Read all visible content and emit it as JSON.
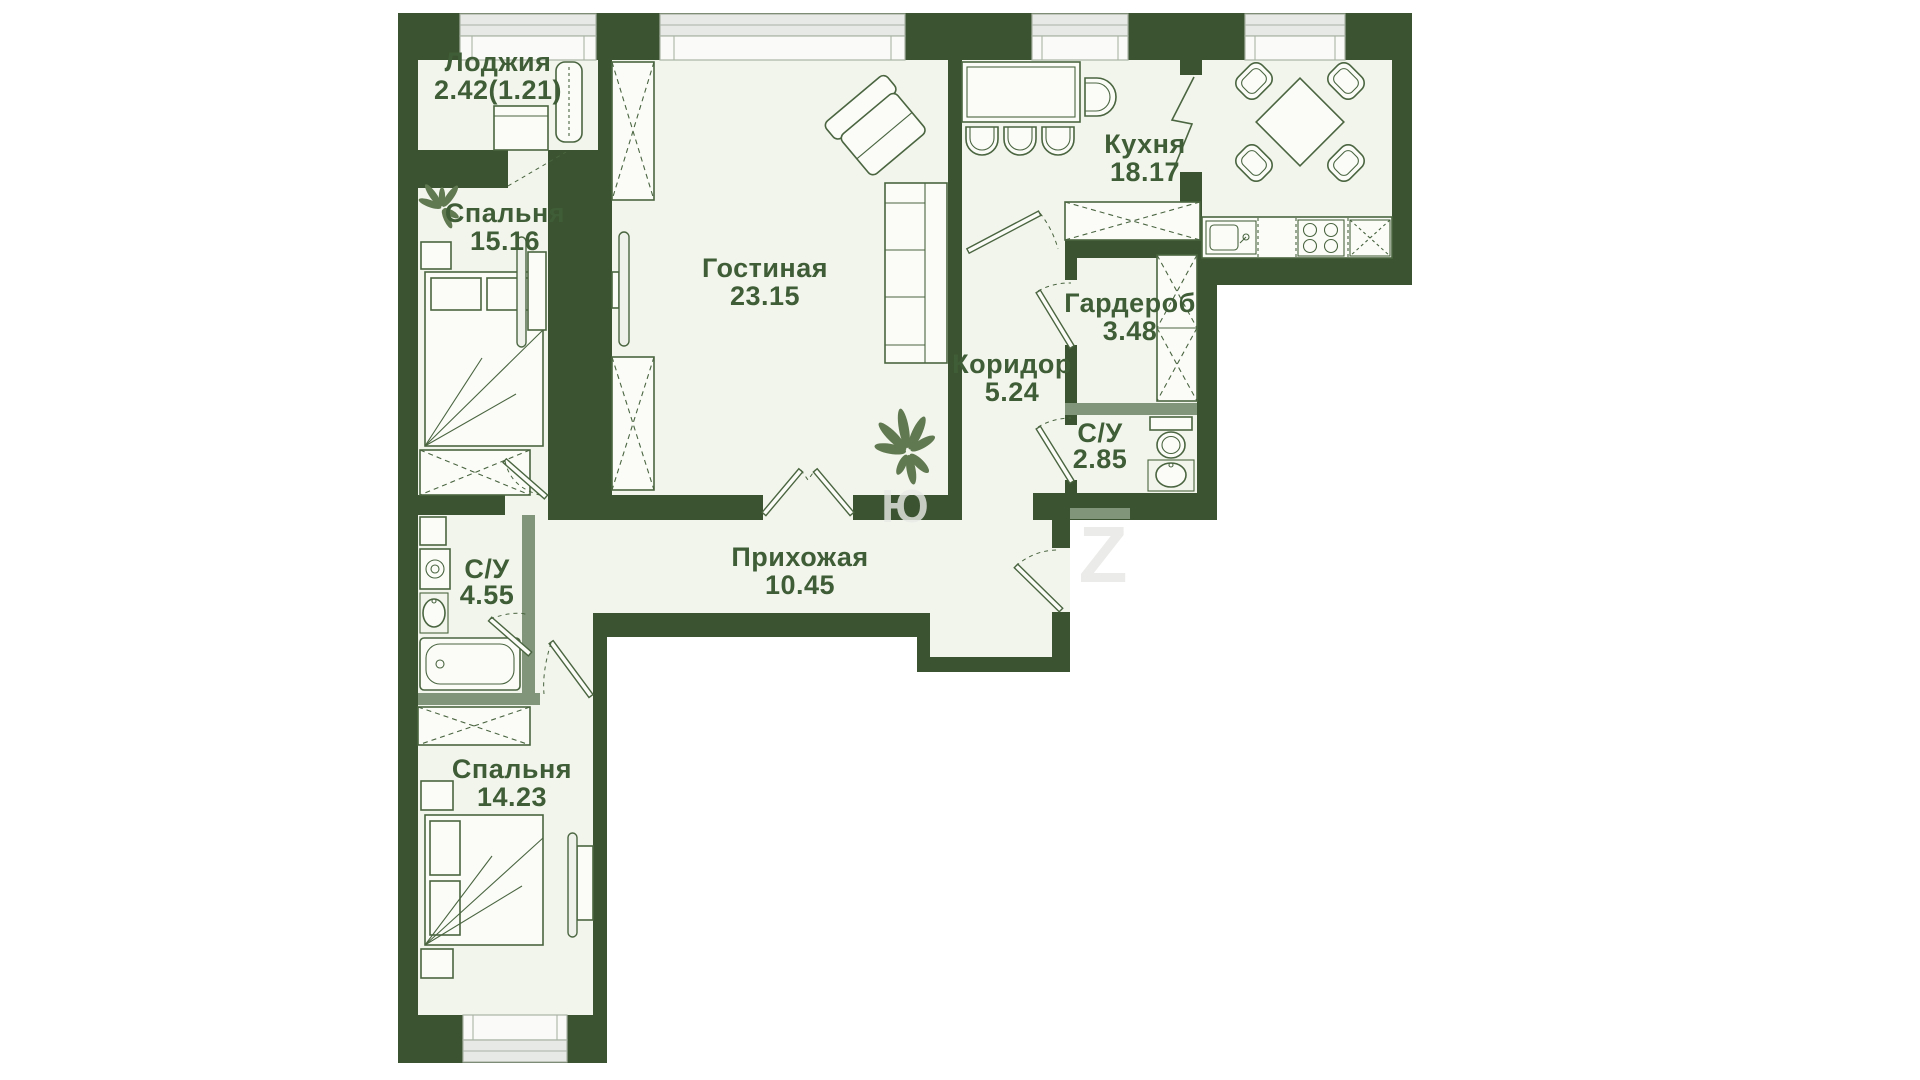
{
  "page": {
    "background": "#ffffff"
  },
  "colors": {
    "wall": "#3b5330",
    "wall_light": "#80957a",
    "floor": "#f2f5ec",
    "furniture_line": "#4a6540",
    "window_fill": "#e6e9e5",
    "label_text": "#3f5d36",
    "plant": "#617951",
    "watermark": "#e9ebe7"
  },
  "rooms": [
    {
      "key": "loggia",
      "name": "Лоджия",
      "area": "2.42(1.21)"
    },
    {
      "key": "bedroom-1",
      "name": "Спальня",
      "area": "15.16"
    },
    {
      "key": "living",
      "name": "Гостиная",
      "area": "23.15"
    },
    {
      "key": "kitchen",
      "name": "Кухня",
      "area": "18.17"
    },
    {
      "key": "wardrobe",
      "name": "Гардероб",
      "area": "3.48"
    },
    {
      "key": "corridor",
      "name": "Коридор",
      "area": "5.24"
    },
    {
      "key": "bathroom-1",
      "name": "С/У",
      "area": "2.85"
    },
    {
      "key": "hallway",
      "name": "Прихожая",
      "area": "10.45"
    },
    {
      "key": "bathroom-2",
      "name": "С/У",
      "area": "4.55"
    },
    {
      "key": "bedroom-2",
      "name": "Спальня",
      "area": "14.23"
    }
  ],
  "watermark": {
    "letters": [
      "Ю",
      "Z"
    ]
  }
}
